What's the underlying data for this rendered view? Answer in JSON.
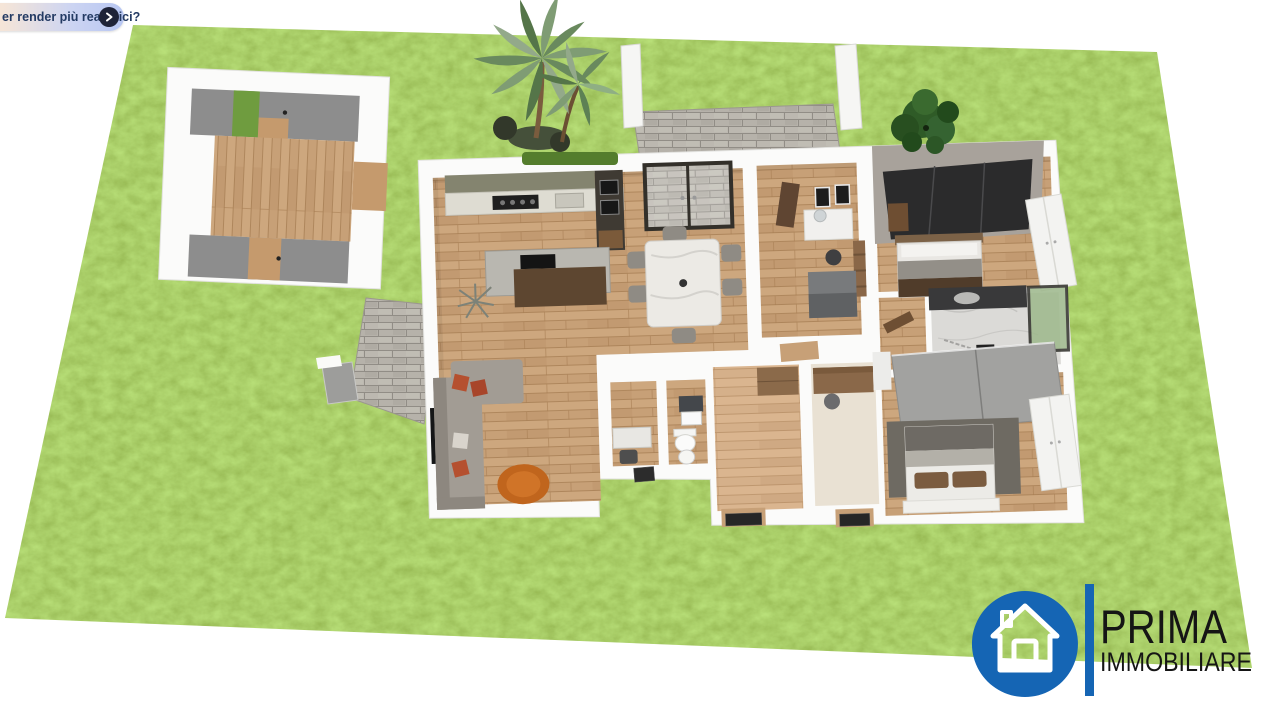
{
  "toast": {
    "text": "er render più realistici?",
    "button_icon": "chevron-right"
  },
  "logo": {
    "brand_top": "PRIMA",
    "brand_bottom": "IMMOBILIARE",
    "icon": "house-in-circle"
  },
  "colors": {
    "logo_blue": "#1565b4",
    "lawn_green": "#66a024",
    "toast_text_color": "#233a63",
    "toast_button_bg": "#1e2338",
    "wall_white": "#fbfbfa",
    "floor_oak": "#c7a077",
    "stone_gray": "#b6b2aa"
  }
}
